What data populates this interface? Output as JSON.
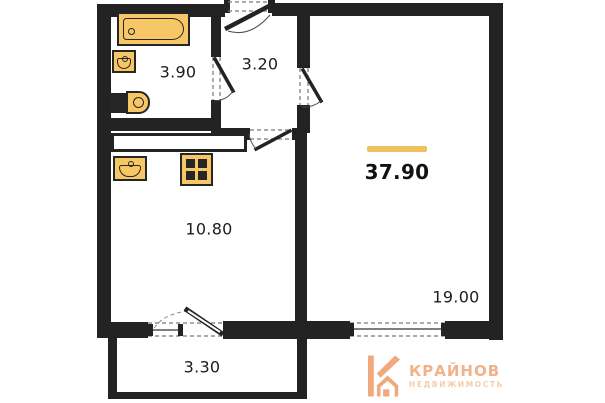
{
  "plan": {
    "rooms": {
      "bathroom": {
        "label": "3.90"
      },
      "hallway": {
        "label": "3.20"
      },
      "kitchen": {
        "label": "10.80"
      },
      "living_room": {
        "label": "19.00"
      },
      "balcony": {
        "label": "3.30"
      }
    },
    "total_area": {
      "label": "37.90"
    },
    "fixtures": [
      "bathtub",
      "washbasin",
      "toilet",
      "kitchen-sink",
      "stove"
    ],
    "openings": [
      "entrance-door",
      "bathroom-door",
      "living-room-door",
      "kitchen-door",
      "balcony-door",
      "kitchen-window",
      "living-room-window"
    ]
  },
  "branding": {
    "name": "КРАЙНОВ",
    "tagline": "НЕДВИЖИМОСТЬ"
  },
  "colors": {
    "wall": "#232323",
    "fixture": "#f7c766",
    "accent": "#f0bf5e",
    "logo": "#f0a87c",
    "logo_text": "#f2b289",
    "logo_tagline": "#f6cda9"
  }
}
